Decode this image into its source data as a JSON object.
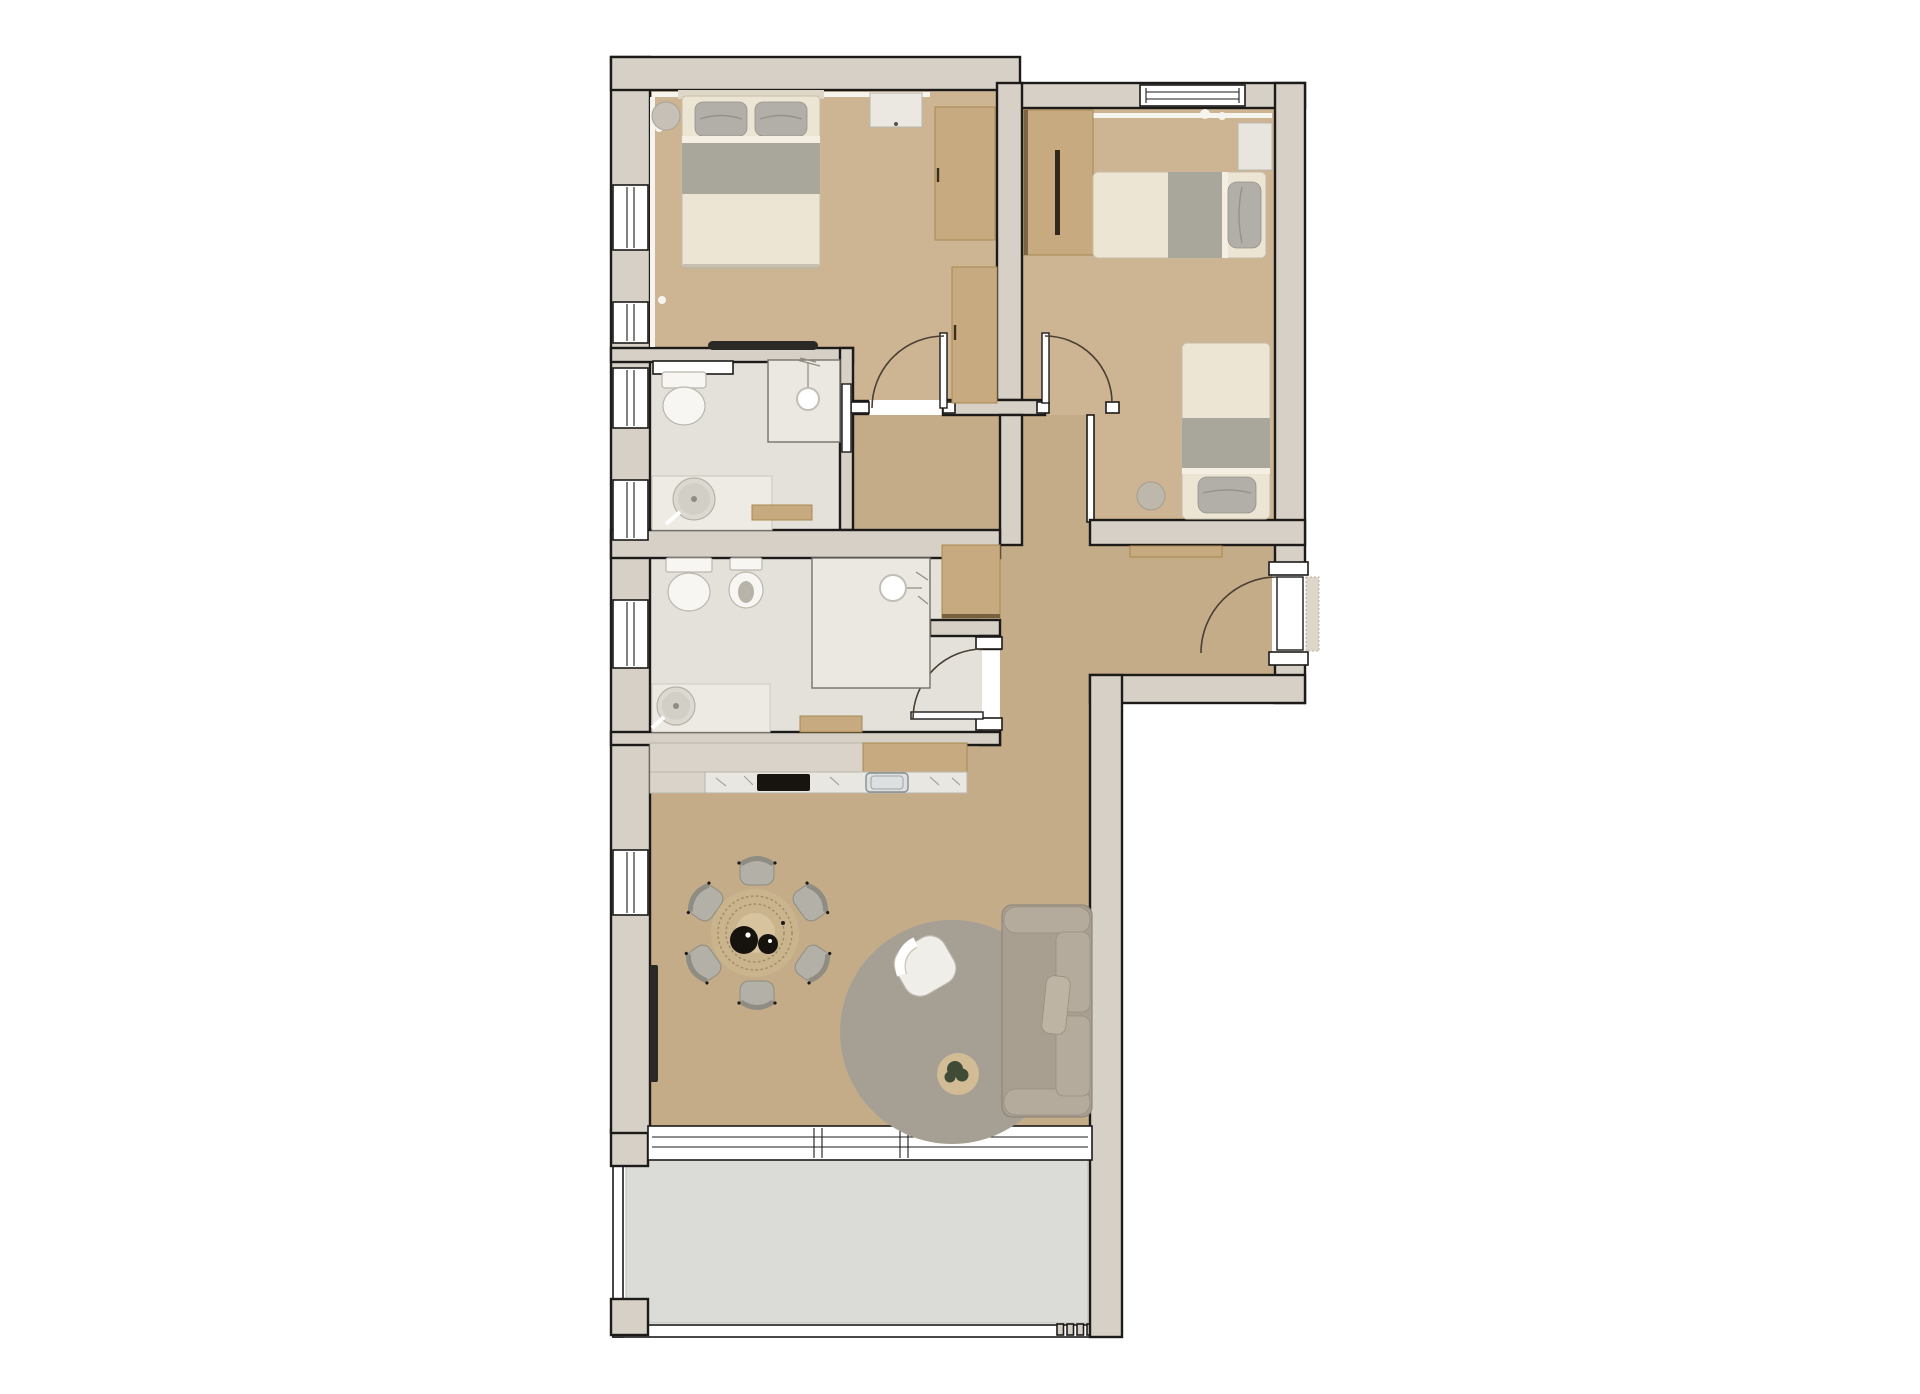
{
  "title": "apartment-floor-plan",
  "colors": {
    "background": "#ffffff",
    "wall_fill": "#d6d0c6",
    "wall_outline": "#1c1b19",
    "wood_light": "#cdb493",
    "wood_mid": "#c5ac89",
    "furniture_wood": "#c8aa81",
    "furniture_wood_dark": "#a9894f",
    "bath_floor": "#e3e1da",
    "shower_floor": "#eae8e1",
    "terrace_floor": "#dbdbd7",
    "white_fixture": "#f7f6f2",
    "fixture_shadow": "#b9b6ad",
    "textile_gray": "#a9a69c",
    "bed_linen": "#ece5d3",
    "pillow_gray": "#b1afa8",
    "sofa_body": "#a99f91",
    "sofa_cushion": "#b4ab9d",
    "rug": "#a6a094",
    "armchair": "#f0eee8",
    "side_table": "#d2bc96",
    "plant": "#3f4b35",
    "dining_table": "#c9b48d",
    "dining_ring": "#a18a62",
    "dining_center": "#d7c49e",
    "chair_gray": "#b2b0a7",
    "chair_dark": "#8f8c82",
    "tray_black": "#16130f",
    "marble": "#e9e7e2",
    "cooktop": "#17140f",
    "sink_steel": "#dde0e0",
    "radiator": "#2b2925",
    "window_white": "#ffffff",
    "door_arc": "#4a3f33",
    "glass_line": "#76726a",
    "curtain": "#f6f4ee",
    "grain": "#7d5a32"
  },
  "plan": {
    "rooms": [
      {
        "name": "master-bedroom",
        "floor": "wood",
        "furniture": [
          "double-bed",
          "two-pillows",
          "nightstand",
          "ottoman",
          "wardrobe",
          "radiator"
        ]
      },
      {
        "name": "second-bedroom",
        "floor": "wood",
        "furniture": [
          "single-bed-horizontal",
          "single-bed-vertical",
          "nightstand",
          "wardrobe",
          "stool"
        ]
      },
      {
        "name": "bathroom-1",
        "floor": "tile",
        "furniture": [
          "toilet",
          "shower",
          "round-basin-vanity",
          "wood-bench",
          "sliding-door",
          "shelf"
        ]
      },
      {
        "name": "bathroom-2",
        "floor": "tile",
        "furniture": [
          "toilet",
          "bidet",
          "shower",
          "round-basin-vanity",
          "wood-shelf",
          "hinged-door"
        ]
      },
      {
        "name": "hallway-entry",
        "floor": "wood",
        "furniture": [
          "tall-cabinet",
          "console-shelf",
          "entrance-door",
          "doormat"
        ]
      },
      {
        "name": "kitchen",
        "floor": "wood",
        "furniture": [
          "counter-run",
          "cooktop",
          "sink"
        ]
      },
      {
        "name": "living-dining-room",
        "floor": "wood",
        "furniture": [
          "round-dining-table",
          "six-chairs",
          "two-trays",
          "round-rug",
          "armchair",
          "sofa",
          "plant-side-table",
          "radiator"
        ]
      },
      {
        "name": "terrace",
        "floor": "concrete",
        "furniture": [
          "railing",
          "piers"
        ]
      }
    ],
    "window_count": 8,
    "door_count": 6
  }
}
